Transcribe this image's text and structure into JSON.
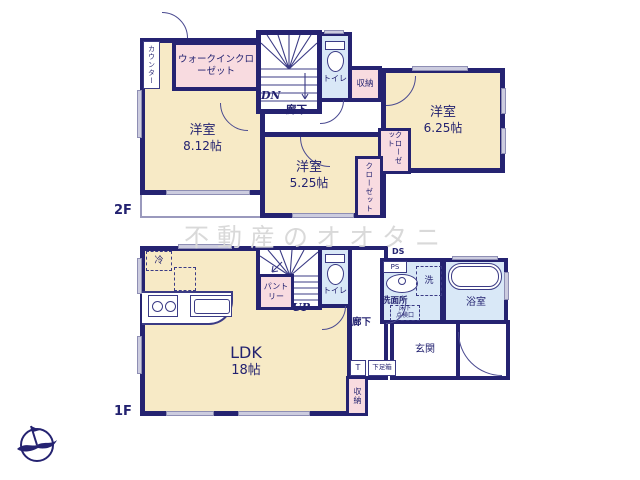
{
  "watermark": "不動産のオオタニ",
  "floor2": {
    "label": "2F",
    "room_812": {
      "name": "洋室",
      "area": "8.12帖"
    },
    "room_525": {
      "name": "洋室",
      "area": "5.25帖"
    },
    "room_625": {
      "name": "洋室",
      "area": "6.25帖"
    },
    "counter": "カウンター",
    "wic": "ウォークインクローゼット",
    "stair_direction": "DN",
    "hallway": "廊下",
    "toilet": "トイレ",
    "storage": "収納",
    "closet_525": "クローゼット",
    "closet_625": "クローゼット"
  },
  "floor1": {
    "label": "1F",
    "ldk": {
      "name": "LDK",
      "area": "18帖"
    },
    "fridge": "冷",
    "pantry": "パントリー",
    "stair_direction": "UP",
    "toilet": "トイレ",
    "hallway": "廊下",
    "ds": "DS",
    "ps": "PS",
    "washer": "洗",
    "washroom": "洗面所",
    "inspection_line1": "床下",
    "inspection_line2": "点検口",
    "bathroom": "浴室",
    "entrance": "玄関",
    "shoebox_t": "T",
    "shoebox": "下足箱",
    "storage": "収納"
  },
  "colors": {
    "wall": "#252371",
    "room_fill": "#f7eac6",
    "closet_fill": "#f8dbe0",
    "wet_area_fill": "#d9e8f7",
    "window": "#ccccdf",
    "text": "#232270",
    "watermark": "#d9d9d9"
  }
}
